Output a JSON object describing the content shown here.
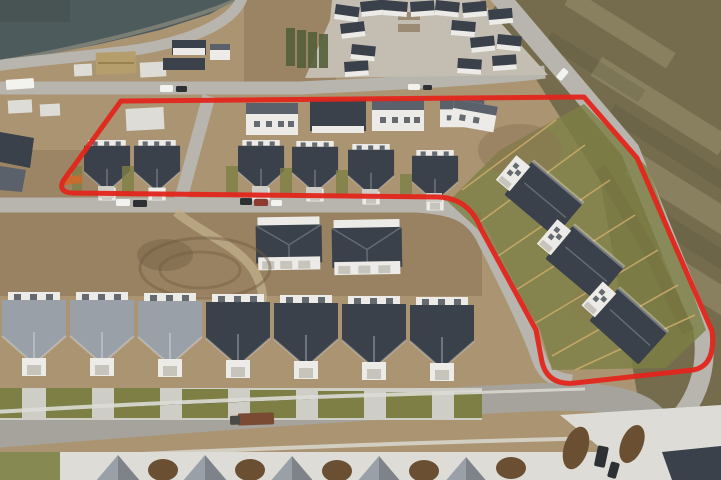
{
  "annotation": {
    "label": "highlighted-lots-outline",
    "shape": "closed polygon drawn over one row of homes and one column of homes",
    "color": "#e3251c",
    "stroke_width": 5,
    "path": "M121 101 L584 97 L637 158 L712 331 Q716 366 693 370 L575 383 Q548 386 542 362 L536 330 L481 229 Q469 198 438 197 L72 193 Q58 192 63 181 Z"
  },
  "scene": {
    "type": "aerial-drone-photo",
    "subject": "new residential subdivision under construction",
    "regions": {
      "top_left": "retention pond with curving road",
      "top_center": "construction slabs and buildings",
      "top_right": "dense finished neighborhood and open field beyond main road",
      "center_left": "graded dirt lot with excavation",
      "center": "two duplex buildings",
      "bottom": "rows of completed homes with driveways",
      "inside_outline": "one row of homes along upper street and one column of homes along the main road"
    },
    "counts": {
      "outlined_top_row_houses": 6,
      "outlined_rear_row_houses": 3,
      "outlined_right_column_houses": 4,
      "duplex_buildings": 2,
      "bottom_row_houses": 7,
      "bottom_edge_roof_peaks": 5
    }
  },
  "colors": {
    "base": "#ab9472",
    "dirt_dark": "#8a7354",
    "dirt_light": "#c2b08d",
    "water": "#4e5b5d",
    "water_dark": "#44504c",
    "shore": "#8f8d7f",
    "road": "#b7b5ad",
    "road_dark": "#a5a39b",
    "concrete": "#dddcd6",
    "concrete_dim": "#cfcec6",
    "roof_dark": "#3a414b",
    "roof_mid": "#5a616a",
    "roof_light": "#99a0a8",
    "wall_white": "#ecebe7",
    "door": "#c6c4bb",
    "lawn": "#7d7f45",
    "lawn_bright": "#8f9150",
    "hedge": "#55603a",
    "field": "#746c4d",
    "field_light": "#d8cfa8",
    "field_dark": "#4a4733",
    "fence_tan": "#c9a96a",
    "berm": "#5f4d38",
    "mound": "#6b4f33",
    "pavilion": "#b59e6b",
    "equip_orange": "#c96a2e",
    "car_white": "#f2f2ef",
    "car_dark": "#2e3134",
    "car_red": "#8d3a30",
    "truck_rust": "#7a4a33"
  }
}
